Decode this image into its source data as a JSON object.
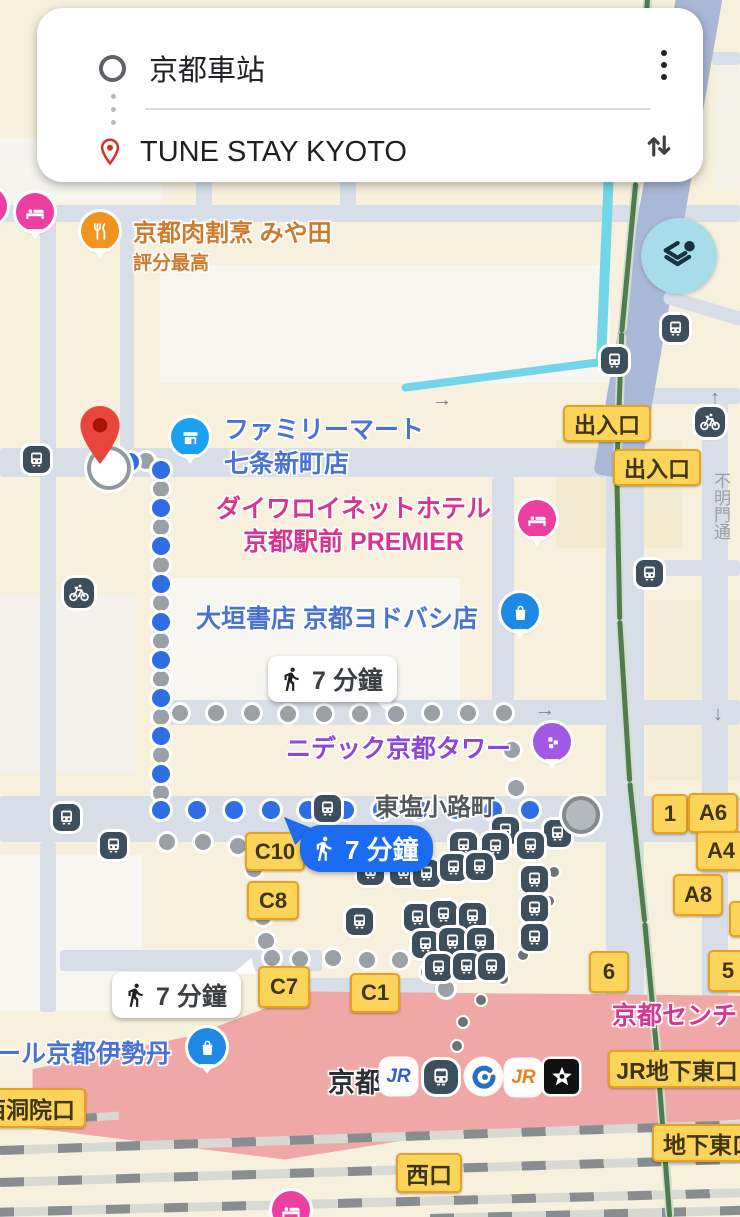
{
  "search_card": {
    "origin": "京都車站",
    "destination": "TUNE STAY KYOTO"
  },
  "route_labels": {
    "walk_selected": "7 分鐘",
    "walk_alt_mid": "7 分鐘",
    "walk_alt_bottom": "7 分鐘"
  },
  "pois": {
    "restaurant": "京都肉割烹 みや田",
    "restaurant_rating": "評分最高",
    "convenience_line1": "ファミリーマート",
    "convenience_line2": "七条新町店",
    "hotel_line1": "ダイワロイネットホテル",
    "hotel_line2": "京都駅前 PREMIER",
    "bookstore": "大垣書店 京都ヨドバシ店",
    "tower": "ニデック京都タワー",
    "district": "東塩小路町",
    "department_store": "ール京都伊勢丹",
    "century_hotel": "京都センチ",
    "station": "京都",
    "street_vertical": "不明門通"
  },
  "gates": [
    "出入口",
    "出入口",
    "C10",
    "C8",
    "C7",
    "C1",
    "1",
    "A6",
    "A4",
    "A8",
    "6",
    "5",
    "JR地下東口",
    "地下東口",
    "西口",
    "西洞院口"
  ],
  "station_logos": {
    "jr_west": "JR",
    "jr_tokai": "JR"
  },
  "colors": {
    "route_blue": "#1b6cf0",
    "dot_blue": "#2f6de4",
    "dot_gray": "#9aa0a6",
    "pin_red": "#ea4335",
    "poi_blue": "#4a73cf",
    "poi_pink": "#d6368f",
    "poi_orange": "#cd7a2c",
    "poi_purple": "#8d46d8",
    "badge_yellow": "#fcd45a",
    "badge_border": "#e8a020",
    "station_pink": "#f0a8a6"
  }
}
